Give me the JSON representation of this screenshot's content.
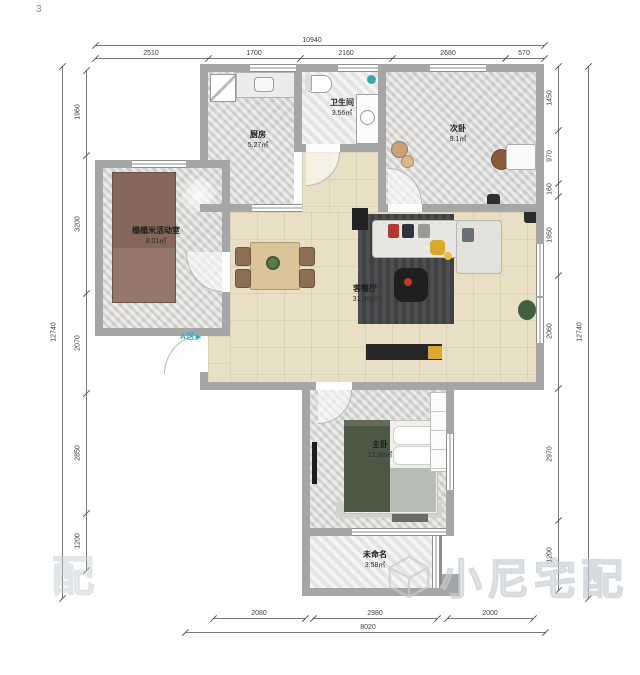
{
  "page": {
    "corner_label": "3",
    "entry_label": "A区",
    "entry_arrow": "▶",
    "watermark_text": "小尼宅配",
    "watermark_partial": "配"
  },
  "rooms": {
    "kitchen": {
      "name": "厨房",
      "area": "5.27㎡"
    },
    "bathroom": {
      "name": "卫生间",
      "area": "3.56㎡"
    },
    "second_bedroom": {
      "name": "次卧",
      "area": "9.1㎡"
    },
    "tatami_room": {
      "name": "榻榻米活动室",
      "area": "8.01㎡"
    },
    "living_dining": {
      "name": "客餐厅",
      "area": "31.36㎡"
    },
    "master_bedroom": {
      "name": "主卧",
      "area": "12.98㎡"
    },
    "unnamed": {
      "name": "未命名",
      "area": "3.58㎡"
    }
  },
  "dimensions": {
    "top": {
      "total": "10940",
      "segments": [
        "2510",
        "1700",
        "2160",
        "2680",
        "570"
      ]
    },
    "left": {
      "total": "12740",
      "segments": [
        "1960",
        "3200",
        "2070",
        "2850",
        "1200"
      ]
    },
    "right": {
      "total": "12740",
      "segments": [
        "1450",
        "970",
        "160",
        "1950",
        "2060",
        "2970",
        "1200"
      ]
    },
    "bottom": {
      "total": "8020",
      "segments": [
        "2080",
        "2980",
        "2000"
      ]
    }
  },
  "colors": {
    "wall": "#a6a6a6",
    "floor_beige": "#e9dfc4",
    "floor_marble": "#d6d5d3",
    "tatami_brown": "#84675a",
    "bed_green": "#4c5844",
    "rug_dark": "#3f4142",
    "accent_teal": "#29b0c6",
    "watermark_gray": "#c6ccd2"
  }
}
